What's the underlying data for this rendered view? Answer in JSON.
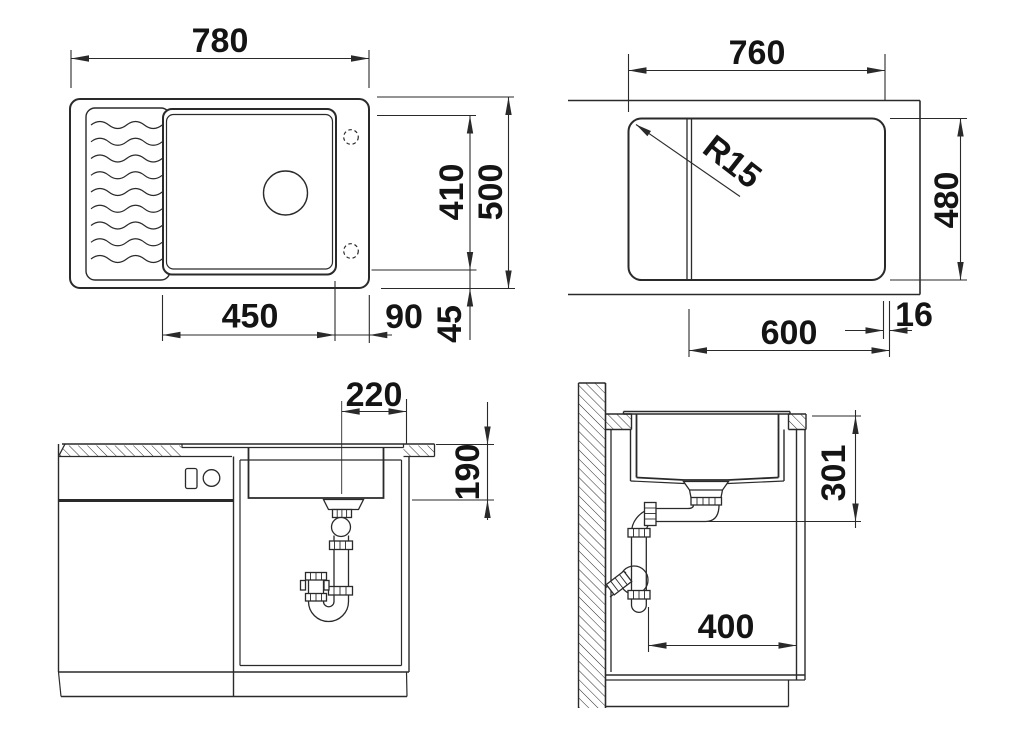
{
  "colors": {
    "line": "#2a2a2a",
    "text": "#141414",
    "background": "#ffffff"
  },
  "views": {
    "sink_top_view": {
      "dims": {
        "overall_width": "780",
        "overall_depth": "500",
        "bowl_inner_depth": "410",
        "bowl_width": "450",
        "bowl_right_offset": "90",
        "edge_margin": "45"
      }
    },
    "cutout_top_view": {
      "dims": {
        "cutout_width": "760",
        "cutout_depth": "480",
        "corner_radius": "R15",
        "bowl_offset": "600",
        "edge_gap": "16"
      }
    },
    "front_section_view": {
      "dims": {
        "drain_offset": "220",
        "bowl_height": "190"
      }
    },
    "side_section_view": {
      "dims": {
        "drain_depth_below_top": "301",
        "cabinet_clearance": "400"
      }
    }
  }
}
